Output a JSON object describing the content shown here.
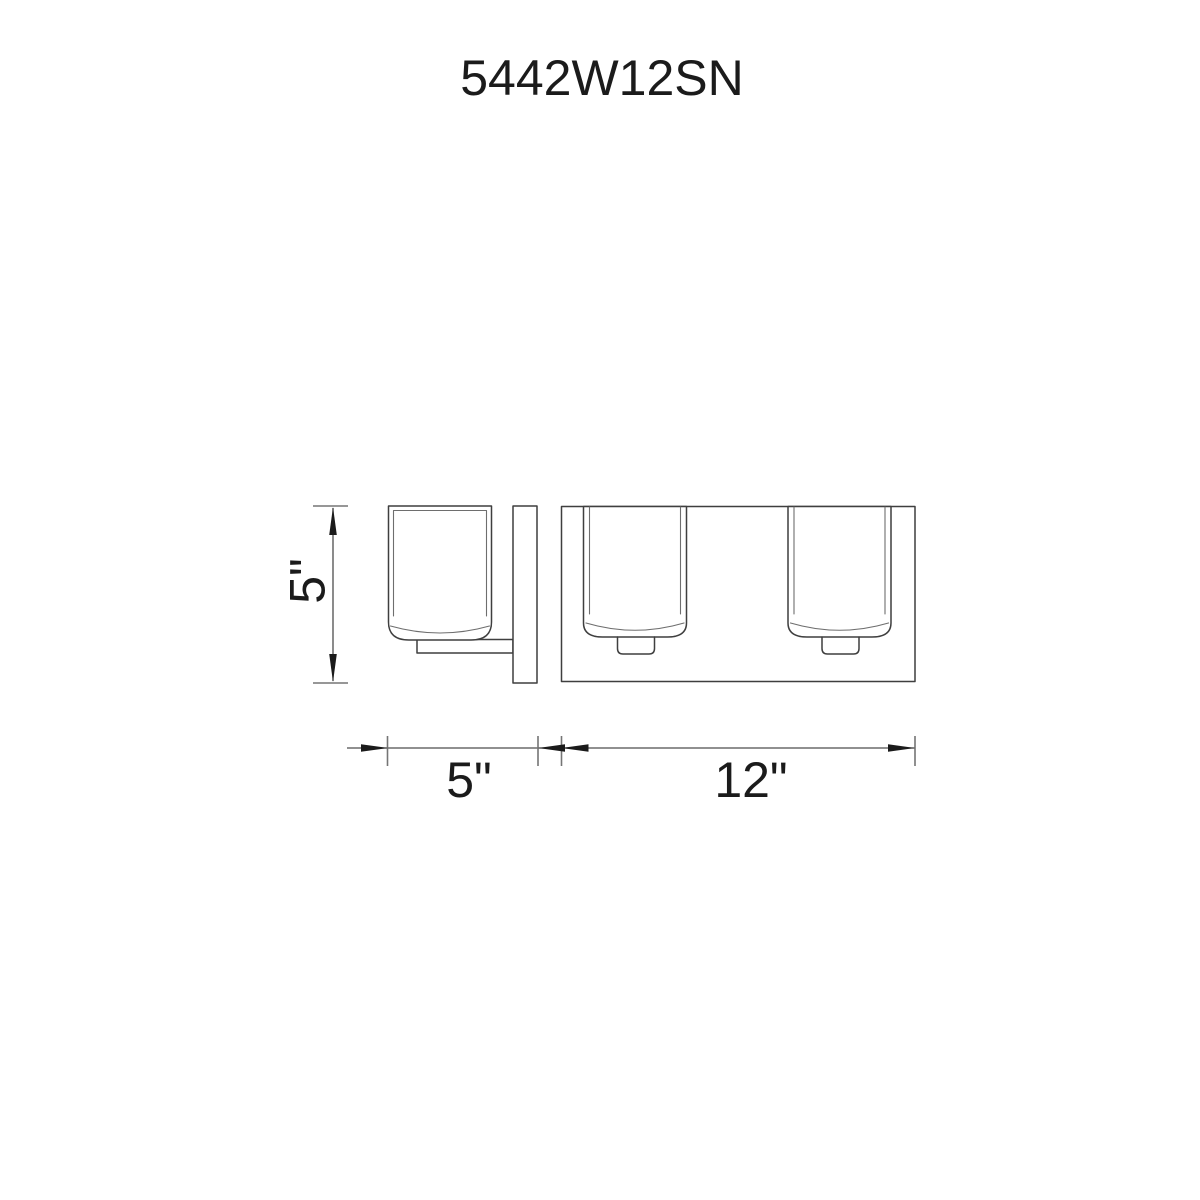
{
  "title": "5442W12SN",
  "dimensions": {
    "height_label": "5\"",
    "depth_label": "5\"",
    "width_label": "12\""
  },
  "colors": {
    "background": "#ffffff",
    "object_line": "#3f3f3f",
    "inner_line": "#6e6e6e",
    "dimension_line": "#4d4d4d",
    "extension_tick": "#757575",
    "text": "#1b1b1b"
  }
}
